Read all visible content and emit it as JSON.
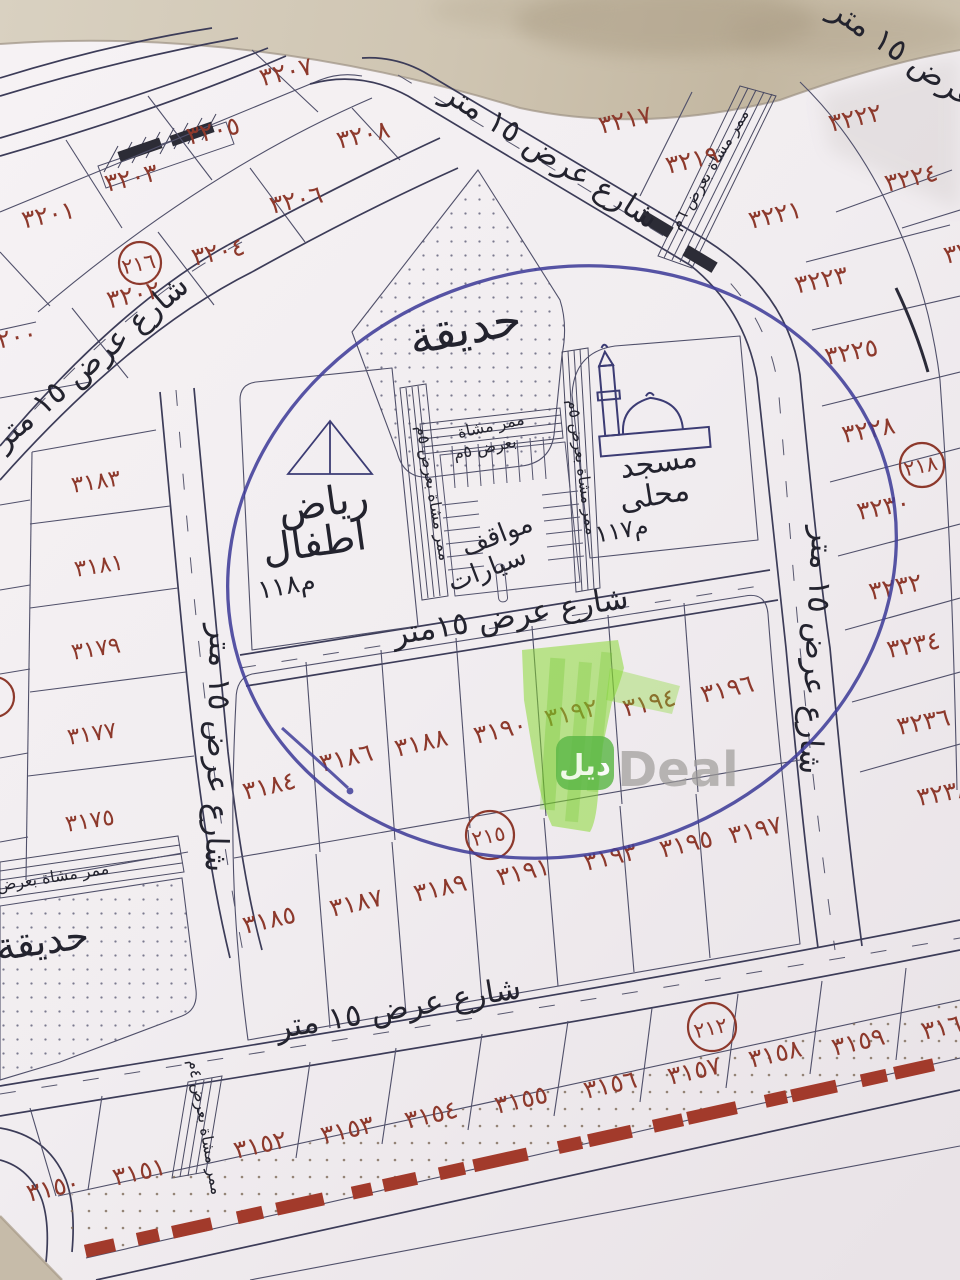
{
  "labels": {
    "street_15m": "شارع عرض ١٥ متر",
    "street_15m_compact": "شارع عرض ١٥متر",
    "walkway_5m": "ممر مشاة بعرض ٥م",
    "walkway_5m_line1": "ممر مشاة",
    "walkway_5m_line2": "بعرض ٥م",
    "walkway_6m": "ممر مشاة بعرض ٦م",
    "walkway_4m": "ممر مشاة بعرض ٤م",
    "park": "حديقة",
    "kindergarten_line1": "رياض",
    "kindergarten_line2": "اطفال",
    "kindergarten_area": "م١١٨",
    "mosque_line1": "مسجد",
    "mosque_line2": "محلى",
    "mosque_area": "م١١٧",
    "parking_line1": "مواقف",
    "parking_line2": "سيارات"
  },
  "block_circles": {
    "b216": "٢١٦",
    "b218": "٢١٨",
    "b215": "٢١٥",
    "b212": "٢١٢"
  },
  "plots": {
    "p3150": "٣١٥٠",
    "p3151": "٣١٥١",
    "p3152": "٣١٥٢",
    "p3153": "٣١٥٣",
    "p3154": "٣١٥٤",
    "p3155": "٣١٥٥",
    "p3156": "٣١٥٦",
    "p3157": "٣١٥٧",
    "p3158": "٣١٥٨",
    "p3159": "٣١٥٩",
    "p3160": "٣١٦٠",
    "p3175": "٣١٧٥",
    "p3177": "٣١٧٧",
    "p3179": "٣١٧٩",
    "p3181": "٣١٨١",
    "p3183": "٣١٨٣",
    "p3184": "٣١٨٤",
    "p3185": "٣١٨٥",
    "p3186": "٣١٨٦",
    "p3187": "٣١٨٧",
    "p3188": "٣١٨٨",
    "p3189": "٣١٨٩",
    "p3190": "٣١٩٠",
    "p3191": "٣١٩١",
    "p3192": "٣١٩٢",
    "p3193": "٣١٩٣",
    "p3194": "٣١٩٤",
    "p3195": "٣١٩٥",
    "p3196": "٣١٩٦",
    "p3197": "٣١٩٧",
    "p3200": "٣٢٠٠",
    "p3201": "٣٢٠١",
    "p3202": "٣٢٠٢",
    "p3203": "٣٢٠٣",
    "p3204": "٣٢٠٤",
    "p3205": "٣٢٠٥",
    "p3206": "٣٢٠٦",
    "p3207": "٣٢٠٧",
    "p3208": "٣٢٠٨",
    "p3217": "٣٢١٧",
    "p3219": "٣٢١٩",
    "p3221": "٣٢٢١",
    "p3222": "٣٢٢٢",
    "p3223": "٣٢٢٣",
    "p3224": "٣٢٢٤",
    "p3225": "٣٢٢٥",
    "p3226": "٣٢٢٦",
    "p3228": "٣٢٢٨",
    "p3230": "٣٢٣٠",
    "p3232": "٣٢٣٢",
    "p3234": "٣٢٣٤",
    "p3236": "٣٢٣٦",
    "p3238": "٣٢٣٨"
  },
  "watermark": {
    "badge": "ديل",
    "brand": "Deal"
  },
  "ink": {
    "pen_circle_color": "#403d99",
    "highlight_color": "#7ed321",
    "highlighted_plot": "٣١٩٢",
    "plot_number_color": "#8d392c",
    "red_road_color": "#a23a2b"
  }
}
